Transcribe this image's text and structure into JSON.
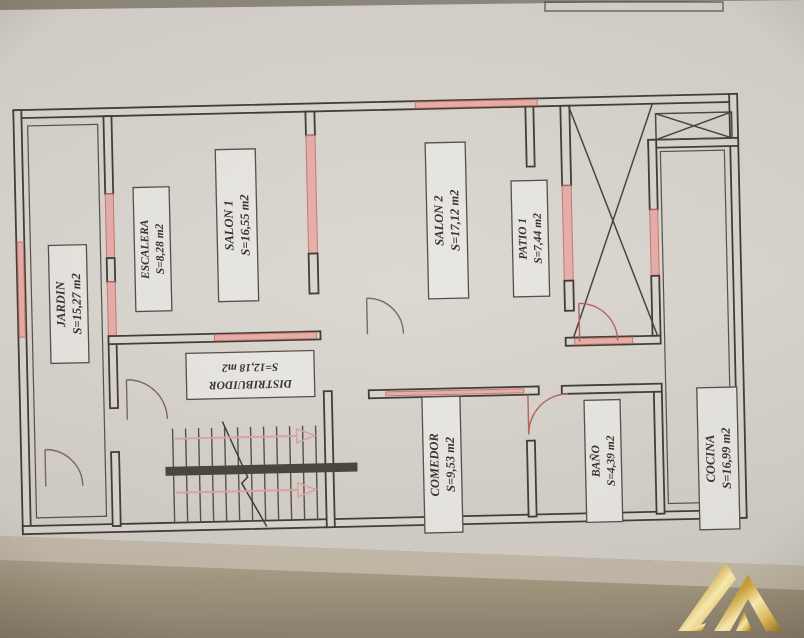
{
  "rooms": [
    {
      "name": "JARDIN",
      "area": "S=15,27 m2"
    },
    {
      "name": "ESCALERA",
      "area": "S=8,28 m2"
    },
    {
      "name": "SALON 1",
      "area": "S=16,55 m2"
    },
    {
      "name": "SALON 2",
      "area": "S=17,12 m2"
    },
    {
      "name": "PATIO 1",
      "area": "S=7,44 m2"
    },
    {
      "name": "DISTRIBUIDOR",
      "area": "S=12,18 m2"
    },
    {
      "name": "COMEDOR",
      "area": "S=9,53 m2"
    },
    {
      "name": "BAÑO",
      "area": "S=4,39 m2"
    },
    {
      "name": "COCINA",
      "area": "S=16,99 m2"
    }
  ],
  "logo": {
    "icon": "gold-mountain-peaks-logo"
  },
  "colors": {
    "paper": "#dbd7d1",
    "wall_line": "#413e38",
    "window_pink": "#e8b0aa",
    "door_red": "#b5645e",
    "desk_tan": "#a2977f",
    "logo_gold": "#d9b455"
  }
}
